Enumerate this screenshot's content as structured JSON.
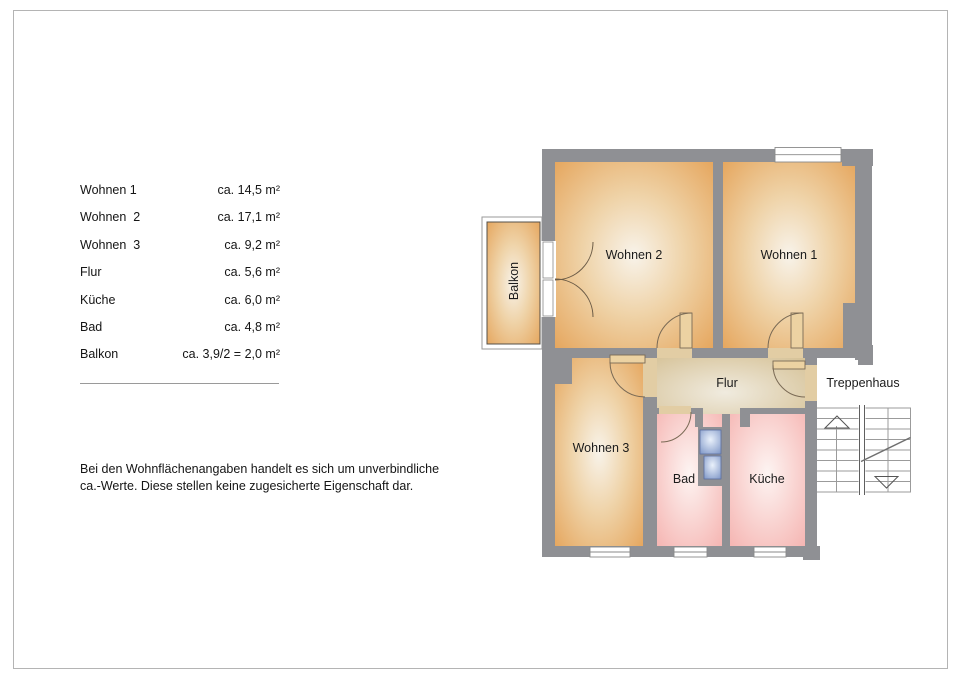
{
  "legend": {
    "rows": [
      {
        "label": "Wohnen 1",
        "value": "ca. 14,5 m²"
      },
      {
        "label": "Wohnen  2",
        "value": "ca. 17,1 m²"
      },
      {
        "label": "Wohnen  3",
        "value": "ca. 9,2 m²"
      },
      {
        "label": "Flur",
        "value": "ca. 5,6 m²"
      },
      {
        "label": "Küche",
        "value": "ca. 6,0 m²"
      },
      {
        "label": "Bad",
        "value": "ca. 4,8 m²"
      },
      {
        "label": "Balkon",
        "value": "ca. 3,9/2 = 2,0 m²"
      }
    ],
    "disclaimer_line1": "Bei den Wohnflächenangaben handelt es sich um unverbindliche",
    "disclaimer_line2": "ca.-Werte. Diese stellen keine zugesicherte Eigenschaft dar."
  },
  "floorplan": {
    "labels": {
      "wohnen2": "Wohnen 2",
      "wohnen1": "Wohnen 1",
      "wohnen3": "Wohnen 3",
      "flur": "Flur",
      "bad": "Bad",
      "kueche": "Küche",
      "balkon": "Balkon",
      "treppenhaus": "Treppenhaus"
    },
    "colors": {
      "wall": "#8f9094",
      "living_room_edge": "#e5a55c",
      "flur_edge": "#d4bf92",
      "wet_room_edge": "#f5b2af",
      "shaft_blue": "#8098c8",
      "page_border": "#b4b4b4"
    }
  }
}
